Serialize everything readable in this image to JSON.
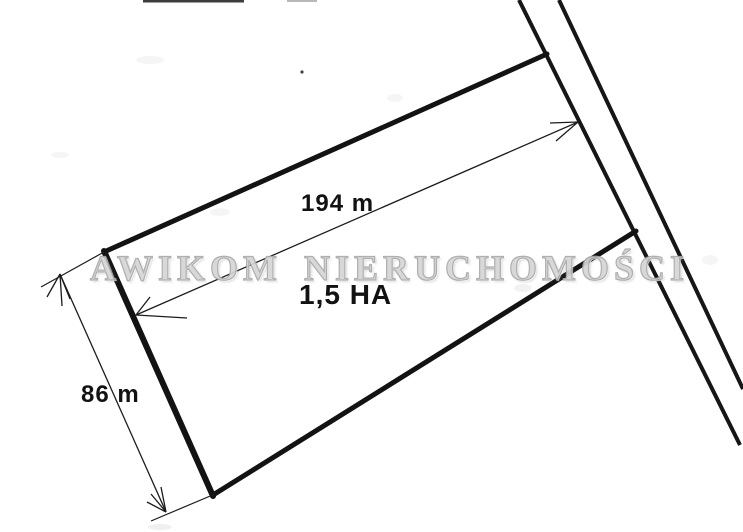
{
  "sketch": {
    "watermark_text": "AWIKOM NIERUCHOMOŚCI",
    "dimensions": {
      "top_length": "194 m",
      "left_width": "86 m",
      "area": "1,5 HA"
    },
    "colors": {
      "ink": "#161616",
      "watermark": "#c8c8c8",
      "background": "#ffffff"
    }
  }
}
